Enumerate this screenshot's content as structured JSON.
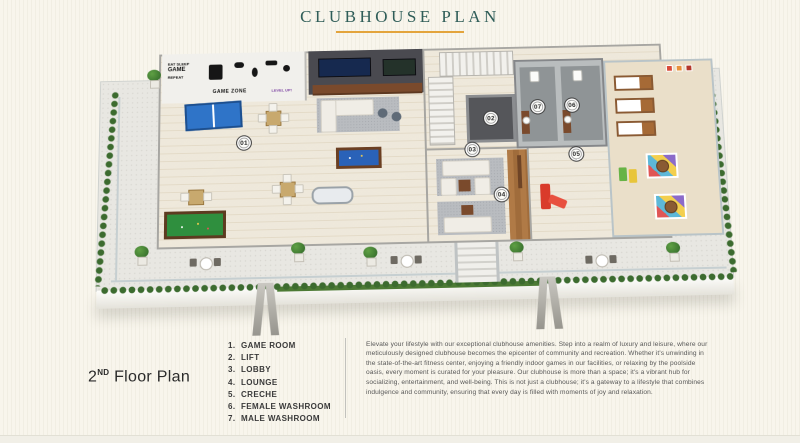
{
  "header": {
    "title": "CLUBHOUSE PLAN"
  },
  "plan": {
    "badges": [
      {
        "label": "01"
      },
      {
        "label": "02"
      },
      {
        "label": "03"
      },
      {
        "label": "04"
      },
      {
        "label": "05"
      },
      {
        "label": "06"
      },
      {
        "label": "07"
      }
    ],
    "decals": {
      "eat": "EAT SLEEP",
      "game": "GAME",
      "repeat": "REPEAT",
      "zone": "GAME ZONE",
      "level": "LEVEL UP!"
    }
  },
  "footer": {
    "floor": {
      "num": "2",
      "sup": "ND",
      "rest": " Floor Plan"
    },
    "legend": {
      "items": [
        {
          "num": "1.",
          "label": "GAME ROOM"
        },
        {
          "num": "2.",
          "label": "LIFT"
        },
        {
          "num": "3.",
          "label": "LOBBY"
        },
        {
          "num": "4.",
          "label": "LOUNGE"
        },
        {
          "num": "5.",
          "label": "CRECHE"
        },
        {
          "num": "6.",
          "label": "FEMALE WASHROOM"
        },
        {
          "num": "7.",
          "label": "MALE WASHROOM"
        }
      ]
    },
    "description": "Elevate your lifestyle with our exceptional clubhouse amenities. Step into a realm of luxury and leisure, where our meticulously designed clubhouse becomes the epicenter of community and recreation. Whether it's unwinding in the state-of-the-art fitness center, enjoying a friendly indoor games in our facilities, or relaxing by the poolside oasis, every moment is curated for your pleasure. Our clubhouse is more than a space; it's a vibrant hub for socializing, entertainment, and well-being. This is not just a clubhouse; it's a gateway to a lifestyle that combines indulgence and community, ensuring that every day is filled with moments of joy and relaxation."
  },
  "colors": {
    "title": "#2f5d58",
    "underline": "#e3a43c",
    "table_blue": "#2f74c8",
    "felt_green": "#2f8f3e",
    "accent_red": "#d93b2b",
    "hedge_green": "#3c6b2f"
  }
}
